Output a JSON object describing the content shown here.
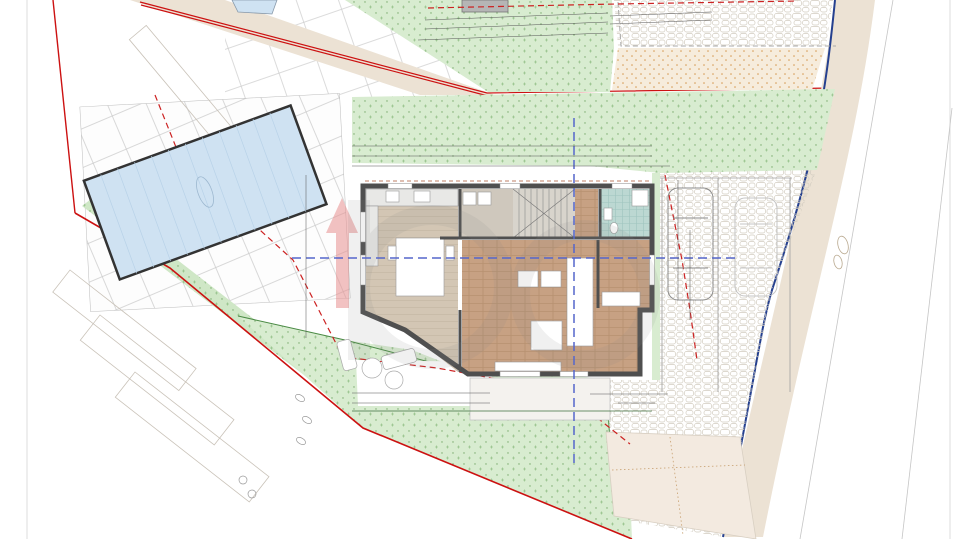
{
  "labels": {
    "parcel": "*34/2",
    "parcel_area": "P:87,39 m²",
    "pool_area": "32,00 m²",
    "sunbathing": "sunšališta",
    "p1": "P1",
    "p2": "P2",
    "section_a": "A",
    "section_b": "B",
    "street_s": "S",
    "level": "±0,00"
  },
  "building": {
    "rooms": [
      {
        "num": "04",
        "name": "Kuhinja",
        "area": "22,23 m²",
        "x": 427,
        "y": 214
      },
      {
        "num": "05",
        "name": "Spremište",
        "area": "5,10 m²",
        "x": 489,
        "y": 205
      },
      {
        "num": "02",
        "name": "Kupaonica",
        "area": "3,25 m²",
        "x": 624,
        "y": 208
      },
      {
        "num": "01",
        "name": "Hodnik",
        "area": "3,76 m²",
        "x": 623,
        "y": 258
      },
      {
        "num": "03",
        "name": "Dnevni boravak",
        "area": "32,77 m²",
        "x": 541,
        "y": 308
      }
    ]
  },
  "site": {
    "elevations": [
      {
        "v": "223.65",
        "x": 40,
        "y": 33,
        "r": -38
      },
      {
        "v": "224.07",
        "x": 100,
        "y": 17,
        "r": -38
      },
      {
        "v": "224.06",
        "x": 110,
        "y": 39,
        "r": -38
      },
      {
        "v": "224.82",
        "x": 115,
        "y": 80,
        "r": -38
      },
      {
        "v": "223.77",
        "x": 196,
        "y": 90,
        "r": -38
      },
      {
        "v": "223.92",
        "x": 320,
        "y": 71,
        "r": 15
      },
      {
        "v": "224.56",
        "x": 456,
        "y": 18,
        "r": -38
      },
      {
        "v": "224.88",
        "x": 618,
        "y": 88,
        "r": -12
      },
      {
        "v": "224.64",
        "x": 698,
        "y": 93,
        "r": -12
      },
      {
        "v": "224.80",
        "x": 813,
        "y": 8,
        "r": -38
      },
      {
        "v": "224.99",
        "x": 869,
        "y": 16,
        "r": -38
      },
      {
        "v": "225.11",
        "x": 804,
        "y": 51,
        "r": -20
      },
      {
        "v": "224.58",
        "x": 791,
        "y": 114,
        "r": -38
      },
      {
        "v": "225.75",
        "x": 843,
        "y": 120,
        "r": -38
      },
      {
        "v": "225.60",
        "x": 847,
        "y": 155,
        "r": -38
      },
      {
        "v": "225.54",
        "x": 878,
        "y": 168,
        "r": -38
      },
      {
        "v": "224.30",
        "x": 108,
        "y": 130,
        "r": -38
      },
      {
        "v": "224.19",
        "x": 94,
        "y": 141,
        "r": -38
      },
      {
        "v": "224.31",
        "x": 56,
        "y": 148,
        "r": -38
      },
      {
        "v": "224.37",
        "x": 52,
        "y": 178,
        "r": -38
      },
      {
        "v": "224.61",
        "x": 50,
        "y": 217,
        "r": -38
      },
      {
        "v": "224.65",
        "x": 72,
        "y": 259,
        "r": -38
      },
      {
        "v": "224.86",
        "x": 113,
        "y": 288,
        "r": -38
      },
      {
        "v": "225.13",
        "x": 136,
        "y": 278,
        "r": -38
      },
      {
        "v": "225.14",
        "x": 133,
        "y": 290,
        "r": -38
      },
      {
        "v": "225.37",
        "x": 125,
        "y": 307,
        "r": -38
      },
      {
        "v": "224.94",
        "x": 106,
        "y": 214,
        "r": -38
      },
      {
        "v": "225.16",
        "x": 152,
        "y": 248,
        "r": -38
      },
      {
        "v": "225.54",
        "x": 150,
        "y": 260,
        "r": -38
      },
      {
        "v": "225.25",
        "x": 181,
        "y": 277,
        "r": -38
      },
      {
        "v": "225.52",
        "x": 189,
        "y": 317,
        "r": -38
      },
      {
        "v": "225.55",
        "x": 232,
        "y": 294,
        "r": -38
      },
      {
        "v": "225.61",
        "x": 276,
        "y": 286,
        "r": -38
      },
      {
        "v": "225.68",
        "x": 266,
        "y": 341,
        "r": -38
      },
      {
        "v": "224.60",
        "x": 130,
        "y": 168,
        "r": -20
      },
      {
        "v": "224.79",
        "x": 150,
        "y": 193,
        "r": -20
      },
      {
        "v": "224.93",
        "x": 187,
        "y": 217,
        "r": -20
      },
      {
        "v": "224.47",
        "x": 497,
        "y": 176,
        "r": -60
      },
      {
        "v": "225.30",
        "x": 350,
        "y": 291,
        "r": -48
      },
      {
        "v": "225.80",
        "x": 330,
        "y": 334,
        "r": -48
      },
      {
        "v": "226.13",
        "x": 318,
        "y": 405,
        "r": -38
      },
      {
        "v": "226.27",
        "x": 364,
        "y": 383,
        "r": -38
      },
      {
        "v": "226.11",
        "x": 398,
        "y": 381,
        "r": -38
      },
      {
        "v": "226.29",
        "x": 396,
        "y": 428,
        "r": -38
      },
      {
        "v": "226.53",
        "x": 374,
        "y": 443,
        "r": -38
      },
      {
        "v": "226.36",
        "x": 68,
        "y": 474,
        "r": -25
      },
      {
        "v": "226.19",
        "x": 711,
        "y": 295,
        "r": -38
      },
      {
        "v": "225.90",
        "x": 751,
        "y": 293,
        "r": -38
      },
      {
        "v": "226.15",
        "x": 810,
        "y": 301,
        "r": -38
      },
      {
        "v": "226.26",
        "x": 843,
        "y": 372,
        "r": -38
      },
      {
        "v": "226.91",
        "x": 773,
        "y": 467,
        "r": -38
      },
      {
        "v": "226.58",
        "x": 920,
        "y": 461,
        "r": -38
      },
      {
        "v": "226.62",
        "x": 717,
        "y": 432,
        "r": -38
      },
      {
        "v": "226.89",
        "x": 620,
        "y": 500,
        "r": -38
      },
      {
        "v": "227.13",
        "x": 684,
        "y": 514,
        "r": -38
      },
      {
        "v": "227.21",
        "x": 577,
        "y": 532,
        "r": -20
      }
    ],
    "dimensions": [
      {
        "v": "570",
        "x": 545,
        "y": 15,
        "r": -3
      },
      {
        "v": "670",
        "x": 543,
        "y": 26,
        "r": -3
      },
      {
        "v": "1,729",
        "x": 526,
        "y": 37,
        "r": -3,
        "b": 1
      },
      {
        "v": "20",
        "x": 428,
        "y": 23,
        "r": -3
      },
      {
        "v": "30",
        "x": 444,
        "y": 21,
        "r": -3
      },
      {
        "v": "590",
        "x": 392,
        "y": 30,
        "r": -3
      },
      {
        "v": "50",
        "x": 614,
        "y": 12,
        "r": -3
      },
      {
        "v": "390",
        "x": 661,
        "y": 10,
        "r": -3
      },
      {
        "v": "440",
        "x": 669,
        "y": 20,
        "r": -3
      },
      {
        "v": "50",
        "x": 713,
        "y": 9,
        "r": -3
      },
      {
        "v": "1,380",
        "x": 502,
        "y": 143,
        "b": 1
      },
      {
        "v": "120",
        "x": 357,
        "y": 153
      },
      {
        "v": "1,260",
        "x": 520,
        "y": 153
      },
      {
        "v": "120",
        "x": 357,
        "y": 164
      },
      {
        "v": "50",
        "x": 375,
        "y": 164
      },
      {
        "v": "440",
        "x": 428,
        "y": 164
      },
      {
        "v": "20",
        "x": 468,
        "y": 164
      },
      {
        "v": "520",
        "x": 541,
        "y": 164
      },
      {
        "v": "20",
        "x": 598,
        "y": 164
      },
      {
        "v": "190",
        "x": 638,
        "y": 164
      },
      {
        "v": "50",
        "x": 661,
        "y": 164
      },
      {
        "v": "50",
        "x": 303,
        "y": 180,
        "r": -90
      },
      {
        "v": "50",
        "x": 303,
        "y": 193,
        "r": -90
      },
      {
        "v": "420",
        "x": 305,
        "y": 250,
        "r": -90
      },
      {
        "v": "750",
        "x": 307,
        "y": 292,
        "r": -90
      },
      {
        "v": "240",
        "x": 317,
        "y": 334,
        "r": -90
      },
      {
        "v": "50",
        "x": 675,
        "y": 191,
        "r": -78
      },
      {
        "v": "160",
        "x": 677,
        "y": 213,
        "r": -78
      },
      {
        "v": "440",
        "x": 686,
        "y": 241,
        "r": -78
      },
      {
        "v": "850",
        "x": 694,
        "y": 279,
        "r": -78
      },
      {
        "v": "50",
        "x": 677,
        "y": 286,
        "r": -78
      },
      {
        "v": "180",
        "x": 356,
        "y": 388
      },
      {
        "v": "120",
        "x": 356,
        "y": 398
      },
      {
        "v": "380",
        "x": 427,
        "y": 389
      },
      {
        "v": "430",
        "x": 420,
        "y": 399
      },
      {
        "v": "50",
        "x": 473,
        "y": 389
      },
      {
        "v": "520",
        "x": 540,
        "y": 390
      },
      {
        "v": "620",
        "x": 538,
        "y": 400
      },
      {
        "v": "1,380",
        "x": 500,
        "y": 409,
        "b": 1
      },
      {
        "v": "50",
        "x": 604,
        "y": 390
      },
      {
        "v": "160",
        "x": 629,
        "y": 389
      },
      {
        "v": "50",
        "x": 653,
        "y": 391
      },
      {
        "v": "310",
        "x": 635,
        "y": 400
      }
    ],
    "survey_markers": [
      {
        "x": 75,
        "y": 213
      },
      {
        "x": 855,
        "y": 15
      },
      {
        "x": 830,
        "y": 138
      },
      {
        "x": 797,
        "y": 307
      },
      {
        "x": 760,
        "y": 447
      }
    ],
    "level_markers": [
      {
        "x": 335,
        "y": 213
      },
      {
        "x": 552,
        "y": 248
      },
      {
        "x": 628,
        "y": 303
      }
    ],
    "trees": [
      {
        "x": 455,
        "y": 28,
        "r": 20,
        "t": "d"
      },
      {
        "x": 498,
        "y": 34,
        "r": 18,
        "t": "d"
      },
      {
        "x": 540,
        "y": 46,
        "r": 16,
        "t": "l"
      },
      {
        "x": 592,
        "y": 58,
        "r": 22,
        "t": "l"
      },
      {
        "x": 310,
        "y": 122,
        "r": 19,
        "t": "d"
      },
      {
        "x": 362,
        "y": 126,
        "r": 21,
        "t": "d"
      },
      {
        "x": 416,
        "y": 131,
        "r": 19,
        "t": "d"
      },
      {
        "x": 520,
        "y": 134,
        "r": 21,
        "t": "d"
      },
      {
        "x": 571,
        "y": 128,
        "r": 16,
        "t": "d"
      },
      {
        "x": 755,
        "y": 112,
        "r": 21,
        "t": "l"
      },
      {
        "x": 545,
        "y": 433,
        "r": 44,
        "t": "b"
      },
      {
        "x": 95,
        "y": 58,
        "r": 30,
        "t": "s"
      }
    ]
  },
  "table": {
    "title": "NETO KORISNE POVRŠINE",
    "columns": [
      "ET...",
      "CJ...",
      "R.BR.",
      "PROSTORIJA",
      "TLOCRT"
    ],
    "section": "PRIZEMLJE",
    "rows": [
      [
        "",
        "S2",
        "01",
        "Hodnik",
        "3,76"
      ],
      [
        "",
        "S2",
        "02",
        "Kupaonica",
        "3,25"
      ]
    ]
  }
}
